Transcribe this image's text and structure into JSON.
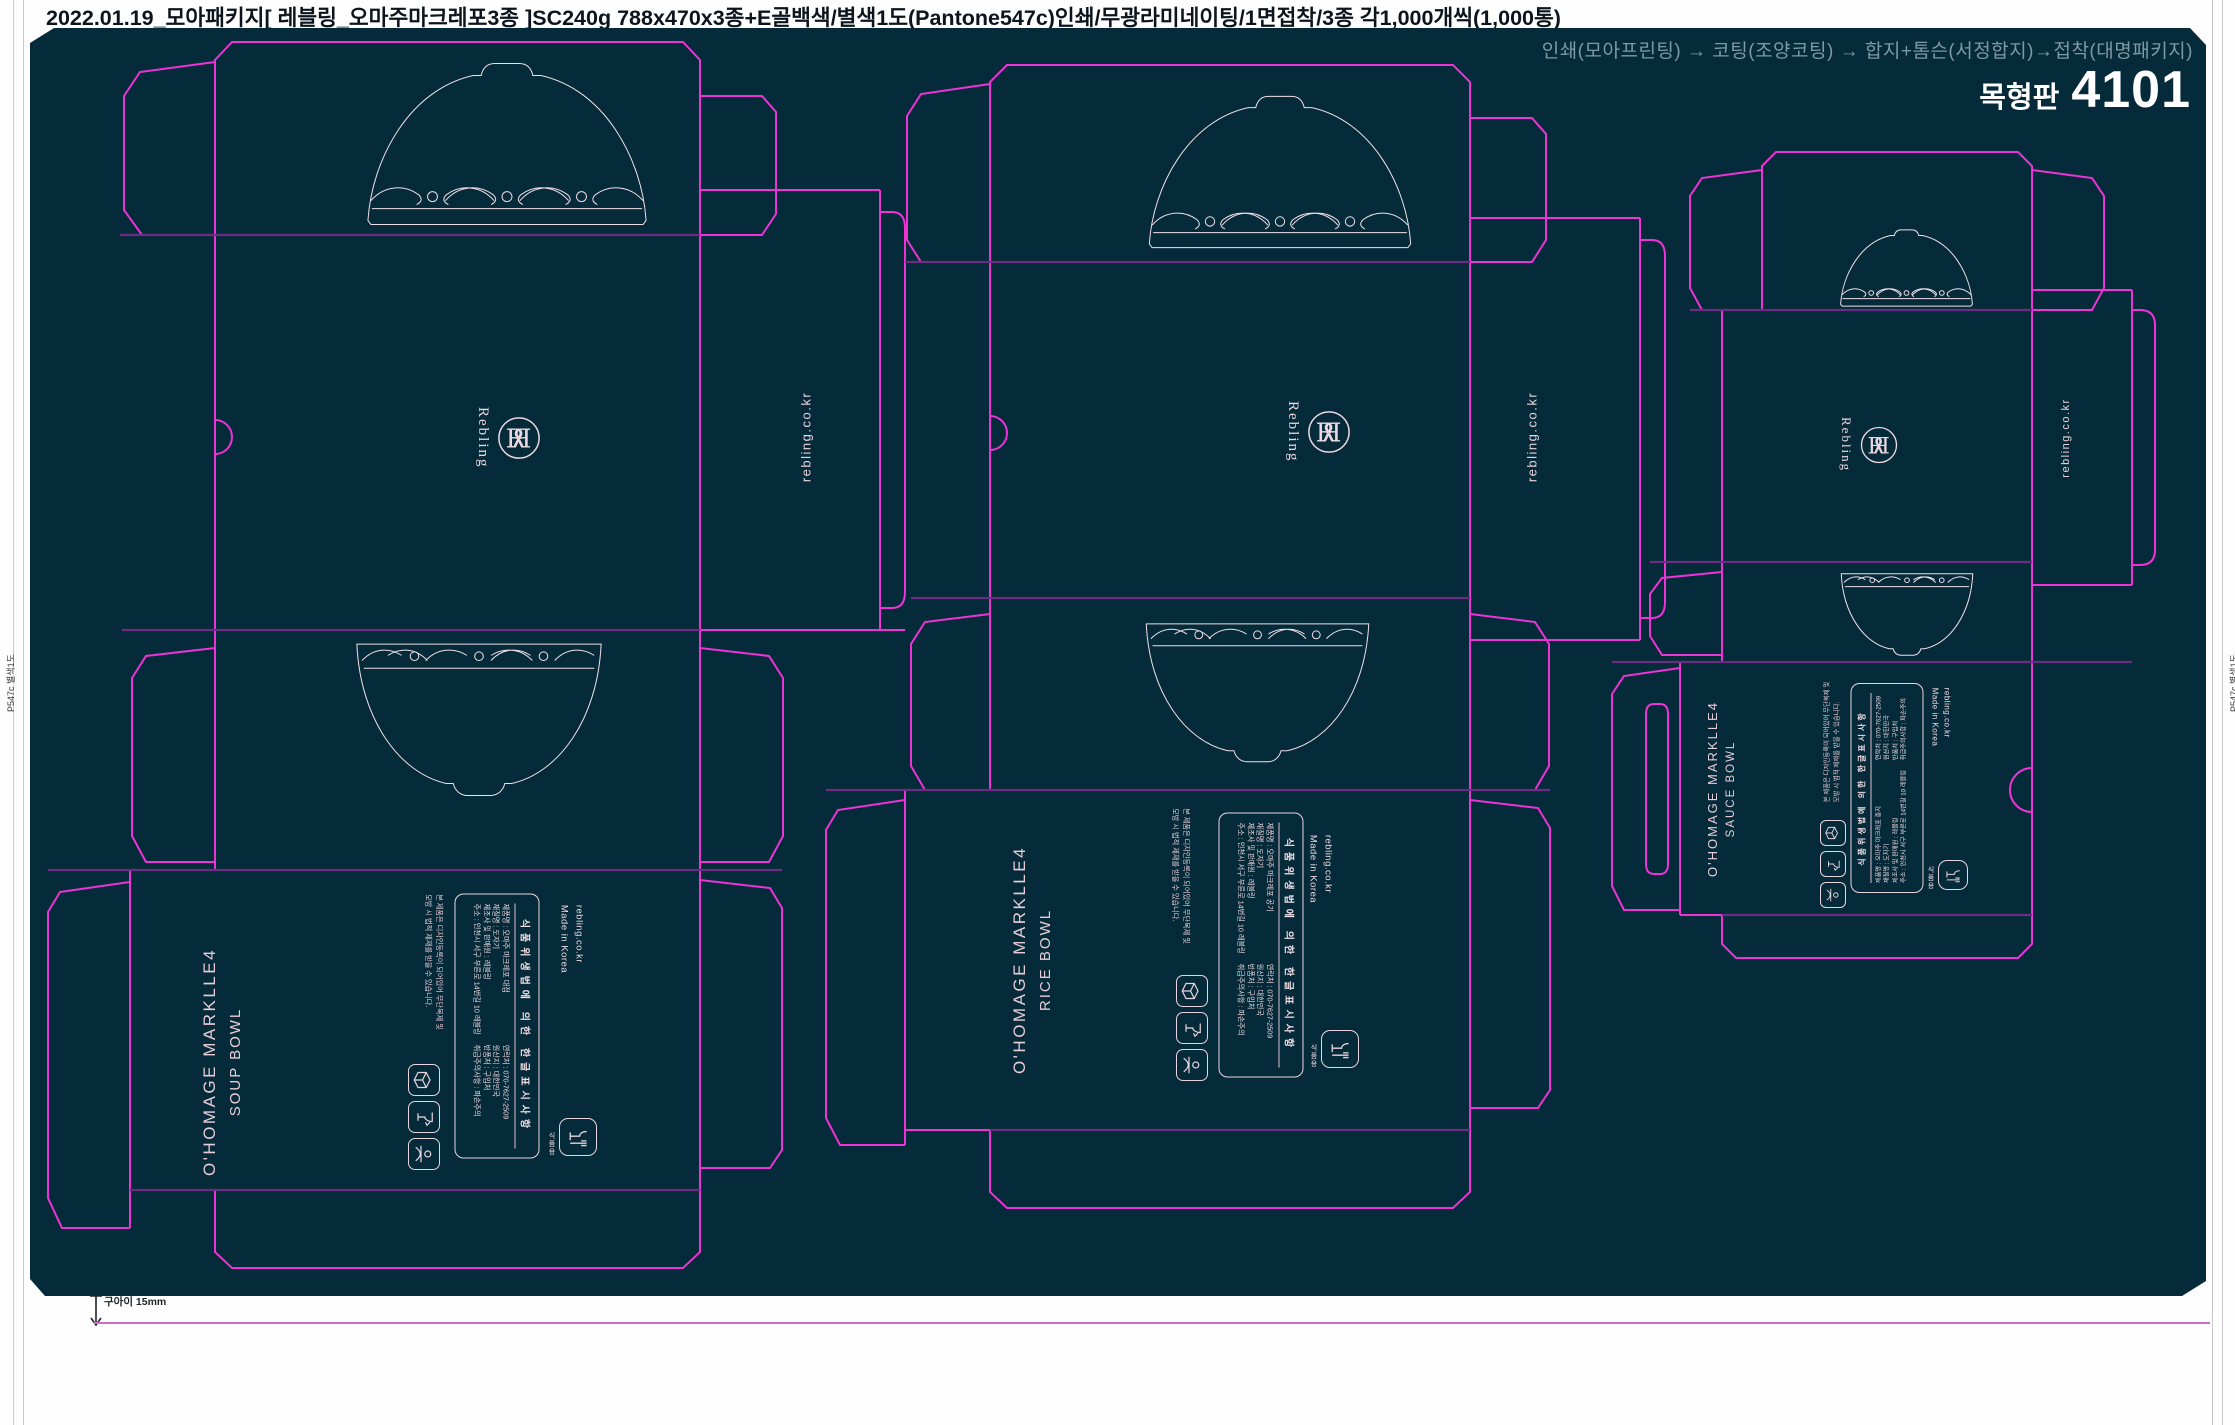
{
  "header": {
    "title": "2022.01.19_모아패키지[ 레블링_오마주마크레포3종 ]SC240g 788x470x3종+E골백색/별색1도(Pantone547c)인쇄/무광라미네이팅/1면접착/3종 각1,000개씩(1,000통)"
  },
  "production": {
    "flow": "인쇄(모아프린팅) → 코팅(조양코팅) → 합지+톰슨(서정합지)→접착(대명패키지)",
    "plate_label": "목형판",
    "plate_number": "4101"
  },
  "margin_marks": {
    "left": "P547c 별색1도",
    "right": "P547c 별색1도",
    "bottom_note": "구아이 15mm"
  },
  "brand": {
    "wordmark": "Rebling",
    "website": "rebling.co.kr",
    "origin": "Made in Korea"
  },
  "label_box": {
    "title": "식품위생법에 의한 한글표시사항",
    "caution_line1": "본 제품은 디자인등록이 되어있어 무단복제 및",
    "caution_line2": "모방 시 법적 제재를 받을 수 있습니다.",
    "food_grade_mark": "식품용",
    "rows_right": [
      "연락처 : 070-7627-2509",
      "원산지 : 대한민국",
      "반품처 : 구입처",
      "취급주의사항 : 파손주의"
    ]
  },
  "dielines": [
    {
      "name_line1": "O'HOMAGE MARKLLE4",
      "name_line2": "SOUP BOWL",
      "rows_left": [
        "제품명 : 오마주 마크레포 대접",
        "재질명 : 도자기",
        "제조사 및 판매원 : 레블링",
        "주소 : 인천시 서구 부른로 14번길 10 레블링"
      ]
    },
    {
      "name_line1": "O'HOMAGE MARKLLE4",
      "name_line2": "RICE BOWL",
      "rows_left": [
        "제품명 : 오마주 마크레포 공기",
        "재질명 : 도자기",
        "제조사 및 판매원 : 레블링",
        "주소 : 인천시 서구 부른로 14번길 10 레블링"
      ]
    },
    {
      "name_line1": "O'HOMAGE MARKLLE4",
      "name_line2": "SAUCE BOWL",
      "rows_left": [
        "제품명 : 오마주 마크레포 종지",
        "재질명 : 도자기",
        "제조사 및 판매원 : 레블링",
        "주소 : 인천시 서구 부른로 14번길 10 레블링"
      ]
    }
  ],
  "colors": {
    "board_bg": "#052b3a",
    "cut_line": "#ee33d6",
    "fold_line": "#6a2d82",
    "artwork": "#f0dfe7",
    "accent_text": "#e8ccd6"
  }
}
